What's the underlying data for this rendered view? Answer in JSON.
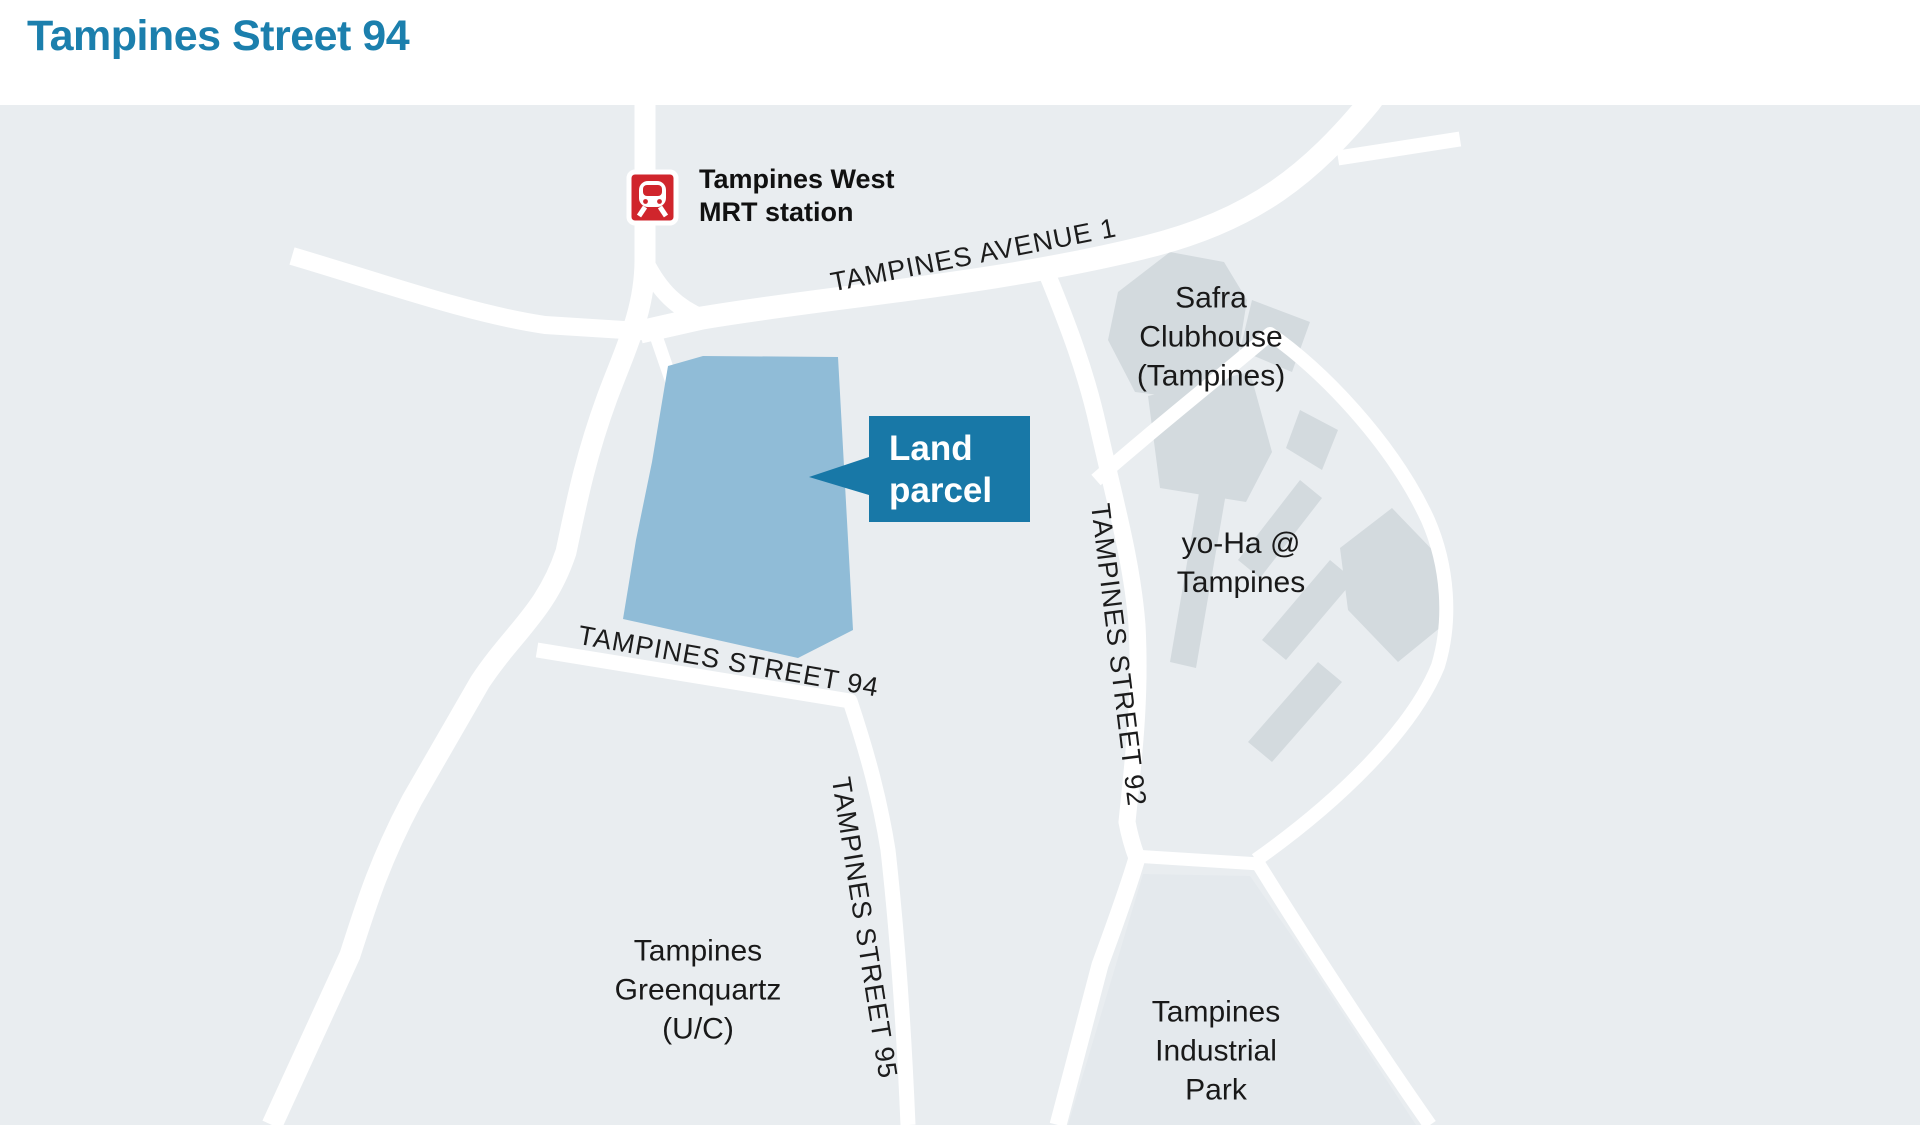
{
  "title": "Tampines Street 94",
  "colors": {
    "title_blue": "#1b7fad",
    "map_background": "#e9edf0",
    "road_white": "#ffffff",
    "land_parcel_fill": "#90bcd7",
    "callout_background": "#1878a7",
    "callout_text": "#ffffff",
    "building_fill": "#d3dade",
    "industrial_area_fill": "#e4e9ed",
    "label_text": "#191919",
    "mrt_red": "#d0252c"
  },
  "map": {
    "mrt_station": {
      "icon": "mrt-train-icon",
      "line1": "Tampines West",
      "line2": "MRT station"
    },
    "callout": {
      "line1": "Land",
      "line2": "parcel"
    },
    "roads": {
      "avenue1": "TAMPINES AVENUE 1",
      "street94": "TAMPINES STREET 94",
      "street95": "TAMPINES STREET 95",
      "street92": "TAMPINES STREET 92"
    },
    "places": {
      "safra": {
        "line1": "Safra",
        "line2": "Clubhouse",
        "line3": "(Tampines)"
      },
      "yoha": {
        "line1": "yo-Ha @",
        "line2": "Tampines"
      },
      "greenquartz": {
        "line1": "Tampines",
        "line2": "Greenquartz",
        "line3": "(U/C)"
      },
      "industrial": {
        "line1": "Tampines",
        "line2": "Industrial",
        "line3": "Park"
      }
    }
  }
}
